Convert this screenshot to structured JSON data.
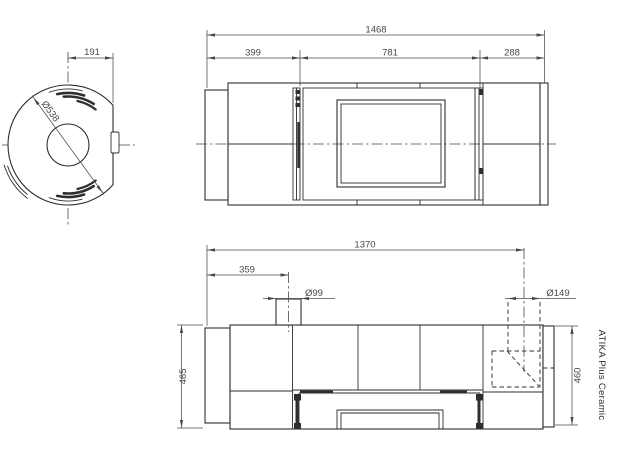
{
  "product": {
    "name": "ATIKA Plus Ceramic"
  },
  "top_view": {
    "dims": {
      "flue_offset": "191",
      "body_diameter": "Ø538"
    }
  },
  "front_view": {
    "dims": {
      "overall_width": "1468",
      "left_section": "399",
      "door_section": "781",
      "right_section": "288"
    }
  },
  "side_view": {
    "dims": {
      "rear_flue_distance": "1370",
      "top_flue_distance": "359",
      "top_flue_diameter": "Ø99",
      "rear_flue_diameter": "Ø149",
      "height_left": "465",
      "height_right": "460"
    }
  },
  "colors": {
    "line": "#2e2e2e",
    "dim": "#4a4a4a",
    "background": "#ffffff"
  }
}
